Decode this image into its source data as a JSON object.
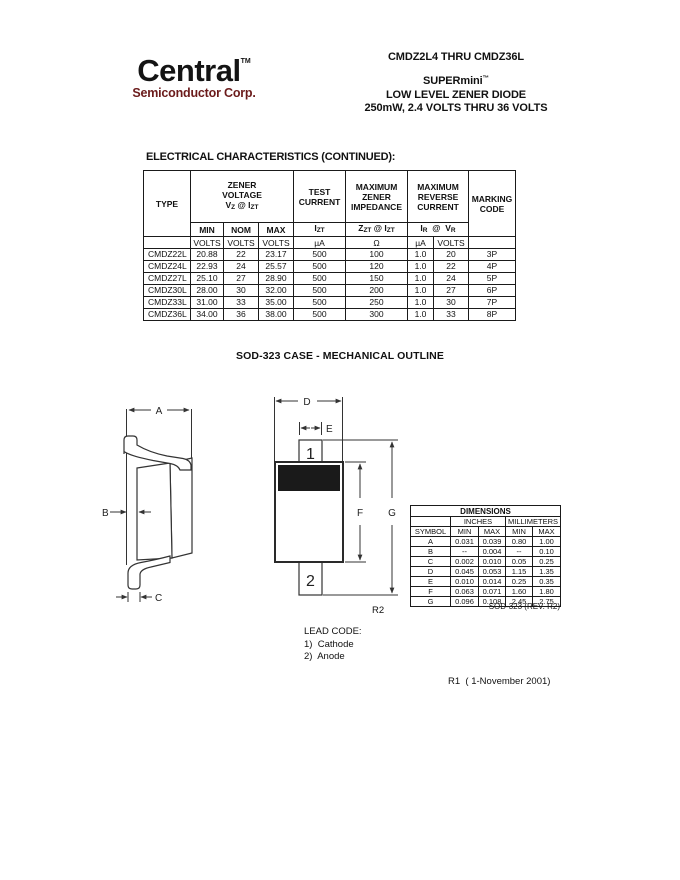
{
  "brand": {
    "name": "Central",
    "tm": "TM",
    "tagline": "Semiconductor Corp.",
    "tagline_color": "#6b1b1b"
  },
  "title_block": {
    "part_range": "CMDZ2L4 THRU CMDZ36L",
    "family": "SUPERmini",
    "family_tm": "™",
    "line2": "LOW LEVEL ZENER DIODE",
    "line3": "250mW, 2.4 VOLTS THRU 36 VOLTS"
  },
  "electrical": {
    "heading": "ELECTRICAL CHARACTERISTICS (CONTINUED):",
    "headers": {
      "type": "TYPE",
      "zener_l1": "ZENER",
      "zener_l2": "VOLTAGE",
      "vz": [
        "V",
        "Z",
        " @ I",
        "ZT"
      ],
      "test_l1": "TEST",
      "test_l2": "CURRENT",
      "imp_l1": "MAXIMUM",
      "imp_l2": "ZENER",
      "imp_l3": "IMPEDANCE",
      "rev_l1": "MAXIMUM",
      "rev_l2": "REVERSE",
      "rev_l3": "CURRENT",
      "mark_l1": "MARKING",
      "mark_l2": "CODE",
      "min": "MIN",
      "nom": "NOM",
      "max": "MAX",
      "izt": [
        "I",
        "ZT"
      ],
      "zzt": [
        "Z",
        "ZT",
        " @ I",
        "ZT"
      ],
      "irvr": [
        "I",
        "R",
        "  @  V",
        "R"
      ],
      "u_volts": "VOLTS",
      "u_ua": "µA",
      "u_ohm": "Ω"
    },
    "rows": [
      {
        "type": "CMDZ22L",
        "min": "20.88",
        "nom": "22",
        "max": "23.17",
        "izt": "500",
        "zzt": "100",
        "ir": "1.0",
        "vr": "20",
        "code": "3P"
      },
      {
        "type": "CMDZ24L",
        "min": "22.93",
        "nom": "24",
        "max": "25.57",
        "izt": "500",
        "zzt": "120",
        "ir": "1.0",
        "vr": "22",
        "code": "4P"
      },
      {
        "type": "CMDZ27L",
        "min": "25.10",
        "nom": "27",
        "max": "28.90",
        "izt": "500",
        "zzt": "150",
        "ir": "1.0",
        "vr": "24",
        "code": "5P"
      },
      {
        "type": "CMDZ30L",
        "min": "28.00",
        "nom": "30",
        "max": "32.00",
        "izt": "500",
        "zzt": "200",
        "ir": "1.0",
        "vr": "27",
        "code": "6P"
      },
      {
        "type": "CMDZ33L",
        "min": "31.00",
        "nom": "33",
        "max": "35.00",
        "izt": "500",
        "zzt": "250",
        "ir": "1.0",
        "vr": "30",
        "code": "7P"
      },
      {
        "type": "CMDZ36L",
        "min": "34.00",
        "nom": "36",
        "max": "38.00",
        "izt": "500",
        "zzt": "300",
        "ir": "1.0",
        "vr": "33",
        "code": "8P"
      }
    ]
  },
  "mechanical": {
    "heading": "SOD-323 CASE - MECHANICAL OUTLINE",
    "labels": {
      "a": "A",
      "b": "B",
      "c": "C",
      "d": "D",
      "e": "E",
      "f": "F",
      "g": "G",
      "pin1": "1",
      "pin2": "2",
      "r2": "R2"
    },
    "dim_table": {
      "title": "DIMENSIONS",
      "inches": "INCHES",
      "millimeters": "MILLIMETERS",
      "symbol": "SYMBOL",
      "min": "MIN",
      "max": "MAX",
      "rows": [
        {
          "symbol": "A",
          "in_min": "0.031",
          "in_max": "0.039",
          "mm_min": "0.80",
          "mm_max": "1.00"
        },
        {
          "symbol": "B",
          "in_min": "--",
          "in_max": "0.004",
          "mm_min": "--",
          "mm_max": "0.10"
        },
        {
          "symbol": "C",
          "in_min": "0.002",
          "in_max": "0.010",
          "mm_min": "0.05",
          "mm_max": "0.25"
        },
        {
          "symbol": "D",
          "in_min": "0.045",
          "in_max": "0.053",
          "mm_min": "1.15",
          "mm_max": "1.35"
        },
        {
          "symbol": "E",
          "in_min": "0.010",
          "in_max": "0.014",
          "mm_min": "0.25",
          "mm_max": "0.35"
        },
        {
          "symbol": "F",
          "in_min": "0.063",
          "in_max": "0.071",
          "mm_min": "1.60",
          "mm_max": "1.80"
        },
        {
          "symbol": "G",
          "in_min": "0.096",
          "in_max": "0.108",
          "mm_min": "2.45",
          "mm_max": "2.75"
        }
      ],
      "footnote": "SOD-323 (REV. R2)"
    },
    "lead_code": {
      "title": "LEAD CODE:",
      "items": [
        "1)  Cathode",
        "2)  Anode"
      ]
    }
  },
  "footer": {
    "revision": "R1  ( 1-November 2001)"
  }
}
